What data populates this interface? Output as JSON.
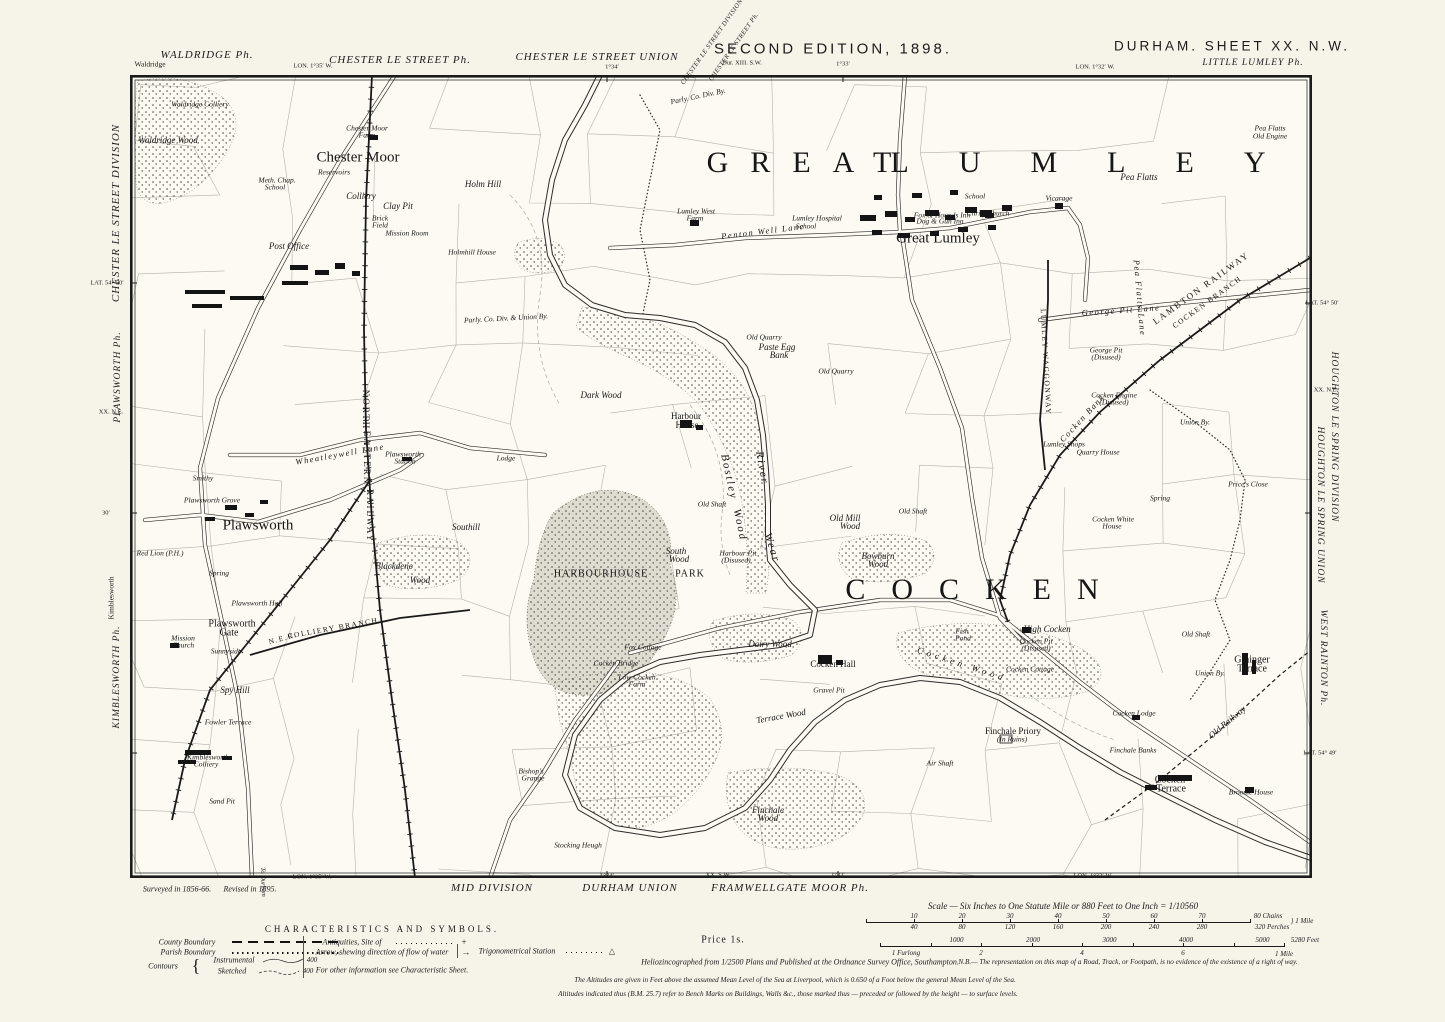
{
  "header": {
    "waldridge_ph": "WALDRIDGE Ph.",
    "waldridge_small": "Waldridge",
    "lon_left": "LON. 1°35′ W.",
    "chester_ph": "CHESTER LE STREET Ph.",
    "chester_union": "CHESTER LE STREET UNION",
    "diag_division": "CHESTER LE STREET DIVISION",
    "diag_ph": "CHESTER LE STREET Ph.",
    "adjoining_sheet": "Dur. XIII. S.W.",
    "tick_134": "1°34′",
    "tick_133": "1°33′",
    "edition": "SECOND EDITION, 1898.",
    "sheet_title": "DURHAM.  SHEET  XX. N.W.",
    "little_lumley": "LITTLE LUMLEY Ph.",
    "lon_right": "LON. 1°32′ W."
  },
  "left_margin": {
    "division": "CHESTER LE STREET DIVISION",
    "lat_top": "LAT. 54° 50′",
    "plawsworth_ph": "PLAWSWORTH Ph.",
    "sheet_ne": "XX. N.E.",
    "tick_30": "30′",
    "kimblesworth_small": "Kimblesworth",
    "kimblesworth_ph": "KIMBLESWORTH Ph."
  },
  "right_margin": {
    "lat_top": "LAT. 54° 50′",
    "sheet_ne": "XX. N.E.",
    "division": "HOUGHTON LE SPRING DIVISION",
    "union": "HOUGHTON LE SPRING UNION",
    "west_rainton_ph": "WEST RAINTON Ph.",
    "lat_bottom": "LAT. 54° 49′"
  },
  "footer": {
    "surveyed": "Surveyed in 1856-66.",
    "revised": "Revised in 1895.",
    "to_durham": "To Durham",
    "lon_left": "LON. 1°35′ W.",
    "mid_division": "MID DIVISION",
    "tick_134": "1°34′",
    "durham_union": "DURHAM UNION",
    "sheet_sw": "XX. S.W.",
    "framwellgate": "FRAMWELLGATE MOOR Ph.",
    "tick_133": "1°33′",
    "lon_right": "LON. 1°32′ W."
  },
  "legend": {
    "title": "CHARACTERISTICS AND SYMBOLS.",
    "county": "County Boundary",
    "parish": "Parish Boundary",
    "contours": "Contours",
    "instrumental": "Instrumental",
    "sketched": "Sketched",
    "contour_value": "400",
    "antiquities": "Antiquities, Site of",
    "antiquities_symbol": "+",
    "arrow": "Arrow, shewing direction of flow of water",
    "arrow_symbol": "→",
    "trig": "Trigonometrical Station",
    "trig_symbol": "△",
    "other_info": "For other information see Characteristic Sheet.",
    "price": "Price 1s."
  },
  "imprint": {
    "helio": "Heliozincographed from 1/2500 Plans and Published at the Ordnance Survey Office, Southampton.",
    "nb": "N.B.— The representation on this map of a Road, Track, or Footpath, is no evidence of the existence of a right of way.",
    "altitudes1": "The Altitudes are given in Feet above the assumed Mean Level of the Sea at Liverpool, which is 0.650 of a Foot below the general Mean Level of the Sea.",
    "altitudes2": "Altitudes indicated thus (B.M. 25.7) refer to Bench Marks on Buildings, Walls &c., those marked thus — preceded or followed by the height — to surface levels."
  },
  "scale": {
    "caption": "Scale — Six Inches to One Statute Mile or 880 Feet to One Inch = 1/10560",
    "chains_ticks": [
      "10",
      "20",
      "30",
      "40",
      "50",
      "60",
      "70"
    ],
    "chains_end": "80 Chains",
    "perches_ticks": [
      "40",
      "80",
      "120",
      "160",
      "200",
      "240",
      "280"
    ],
    "perches_end": "320 Perches",
    "mile_label": "1 Mile",
    "feet_ticks": [
      "1000",
      "2000",
      "3000",
      "4000",
      "5000"
    ],
    "feet_end": "5280 Feet",
    "furlong_label": "1 Furlong",
    "furlong_ticks": [
      "2",
      "4",
      "6"
    ],
    "feet_mile": "1 Mile"
  },
  "map": {
    "labels": [
      {
        "t": "GREAT",
        "x": 810,
        "y": 163,
        "s": "big",
        "ls": 22
      },
      {
        "t": "LUMLEY",
        "x": 1103,
        "y": 163,
        "s": "big",
        "ls": 50
      },
      {
        "t": "COCKEN",
        "x": 985,
        "y": 590,
        "s": "big",
        "ls": 26
      },
      {
        "t": "HARBOURHOUSE",
        "x": 601,
        "y": 574,
        "s": "park"
      },
      {
        "t": "PARK",
        "x": 690,
        "y": 574,
        "s": "park"
      },
      {
        "t": "Chester Moor",
        "x": 358,
        "y": 158,
        "s": "place"
      },
      {
        "t": "Plawsworth",
        "x": 258,
        "y": 526,
        "s": "place"
      },
      {
        "t": "Great Lumley",
        "x": 938,
        "y": 239,
        "s": "place"
      },
      {
        "t": "Plawsworth",
        "x": 232,
        "y": 624,
        "s": "place2"
      },
      {
        "t": "Gate",
        "x": 229,
        "y": 633,
        "s": "place2"
      },
      {
        "t": "NORTH",
        "x": 366,
        "y": 410,
        "s": "rail",
        "r": 90
      },
      {
        "t": "EASTERN",
        "x": 367,
        "y": 458,
        "s": "rail",
        "r": 90
      },
      {
        "t": "RAILWAY",
        "x": 370,
        "y": 516,
        "s": "rail",
        "r": 90
      },
      {
        "t": "LAMBTON RAILWAY",
        "x": 1201,
        "y": 288,
        "s": "rail",
        "r": -36
      },
      {
        "t": "COCKEN BRANCH",
        "x": 1207,
        "y": 302,
        "s": "railsm",
        "r": -36
      },
      {
        "t": "N.E.R.",
        "x": 283,
        "y": 638,
        "s": "railsm",
        "r": -15
      },
      {
        "t": "COLLIERY BRANCH",
        "x": 333,
        "y": 628,
        "s": "railsm",
        "r": -10
      },
      {
        "t": "LUMLEY WAGGONWAY",
        "x": 1046,
        "y": 362,
        "s": "railsm",
        "r": 87
      },
      {
        "t": "Old Railway",
        "x": 1227,
        "y": 722,
        "s": "ital",
        "r": -40
      },
      {
        "t": "Penton Well Lane",
        "x": 763,
        "y": 231,
        "s": "lane",
        "r": -7
      },
      {
        "t": "George Pit Lane",
        "x": 1121,
        "y": 310,
        "s": "lane",
        "r": -4
      },
      {
        "t": "Wheatleywell Lane",
        "x": 340,
        "y": 454,
        "s": "lane",
        "r": -10
      },
      {
        "t": "Cocken Bank",
        "x": 1082,
        "y": 418,
        "s": "lane",
        "r": -47
      },
      {
        "t": "Pea Flatts Lane",
        "x": 1140,
        "y": 298,
        "s": "lane",
        "r": 85
      },
      {
        "t": "Parly. Co. Div. & Union By.",
        "x": 506,
        "y": 318,
        "s": "tiny",
        "r": -3
      },
      {
        "t": "Parly. Co. Div. By.",
        "x": 698,
        "y": 96,
        "s": "tiny",
        "r": -12
      },
      {
        "t": "Waldridge Colliery",
        "x": 200,
        "y": 104,
        "s": "tiny"
      },
      {
        "t": "Waldridge Wood",
        "x": 168,
        "y": 140,
        "s": "ital"
      },
      {
        "t": "Chester Moor",
        "x": 367,
        "y": 128,
        "s": "tiny"
      },
      {
        "t": "Farm",
        "x": 367,
        "y": 135,
        "s": "tiny"
      },
      {
        "t": "Meth. Chap.",
        "x": 277,
        "y": 180,
        "s": "tiny"
      },
      {
        "t": "School",
        "x": 275,
        "y": 187,
        "s": "tiny"
      },
      {
        "t": "Reservoirs",
        "x": 334,
        "y": 172,
        "s": "tiny"
      },
      {
        "t": "Colliery",
        "x": 361,
        "y": 196,
        "s": "ital"
      },
      {
        "t": "Clay Pit",
        "x": 398,
        "y": 206,
        "s": "ital"
      },
      {
        "t": "Brick",
        "x": 380,
        "y": 218,
        "s": "tiny"
      },
      {
        "t": "Field",
        "x": 380,
        "y": 225,
        "s": "tiny"
      },
      {
        "t": "Mission Room",
        "x": 407,
        "y": 233,
        "s": "tiny"
      },
      {
        "t": "Post Office",
        "x": 289,
        "y": 246,
        "s": "ital"
      },
      {
        "t": "Holm Hill",
        "x": 483,
        "y": 184,
        "s": "ital"
      },
      {
        "t": "Holmhill House",
        "x": 472,
        "y": 252,
        "s": "tiny"
      },
      {
        "t": "Smithy",
        "x": 203,
        "y": 478,
        "s": "tiny"
      },
      {
        "t": "Plawsworth Grove",
        "x": 212,
        "y": 500,
        "s": "tiny"
      },
      {
        "t": "Plawsworth",
        "x": 403,
        "y": 454,
        "s": "tiny"
      },
      {
        "t": "Station",
        "x": 405,
        "y": 461,
        "s": "tiny"
      },
      {
        "t": "Red Lion (P.H.)",
        "x": 160,
        "y": 553,
        "s": "tiny"
      },
      {
        "t": "Spring",
        "x": 219,
        "y": 573,
        "s": "tiny"
      },
      {
        "t": "Plawsworth Hall",
        "x": 257,
        "y": 603,
        "s": "tiny"
      },
      {
        "t": "Mission",
        "x": 183,
        "y": 638,
        "s": "tiny"
      },
      {
        "t": "Church",
        "x": 183,
        "y": 645,
        "s": "tiny"
      },
      {
        "t": "Sunnyside",
        "x": 226,
        "y": 651,
        "s": "tiny"
      },
      {
        "t": "Spy Hill",
        "x": 235,
        "y": 690,
        "s": "ital"
      },
      {
        "t": "Fowler Terrace",
        "x": 228,
        "y": 722,
        "s": "tiny"
      },
      {
        "t": "Kimblesworth",
        "x": 208,
        "y": 757,
        "s": "tiny"
      },
      {
        "t": "Colliery",
        "x": 206,
        "y": 764,
        "s": "tiny"
      },
      {
        "t": "Sand Pit",
        "x": 222,
        "y": 801,
        "s": "tiny"
      },
      {
        "t": "Blackdene",
        "x": 394,
        "y": 566,
        "s": "ital"
      },
      {
        "t": "Wood",
        "x": 420,
        "y": 580,
        "s": "ital"
      },
      {
        "t": "Southill",
        "x": 466,
        "y": 527,
        "s": "ital"
      },
      {
        "t": "Lodge",
        "x": 506,
        "y": 458,
        "s": "tiny"
      },
      {
        "t": "Dark Wood",
        "x": 601,
        "y": 395,
        "s": "ital"
      },
      {
        "t": "Harbour",
        "x": 686,
        "y": 416,
        "s": "name"
      },
      {
        "t": "House",
        "x": 687,
        "y": 425,
        "s": "name"
      },
      {
        "t": "Bostley",
        "x": 729,
        "y": 477,
        "s": "water",
        "r": 78
      },
      {
        "t": "Wood",
        "x": 740,
        "y": 525,
        "s": "water",
        "r": 78
      },
      {
        "t": "River",
        "x": 762,
        "y": 468,
        "s": "water",
        "r": 80
      },
      {
        "t": "Wear",
        "x": 772,
        "y": 548,
        "s": "water",
        "r": 72
      },
      {
        "t": "Old Shaft",
        "x": 712,
        "y": 504,
        "s": "tiny"
      },
      {
        "t": "Harbour Pit",
        "x": 738,
        "y": 553,
        "s": "tiny"
      },
      {
        "t": "(Disused)",
        "x": 736,
        "y": 560,
        "s": "tiny"
      },
      {
        "t": "South",
        "x": 676,
        "y": 551,
        "s": "ital"
      },
      {
        "t": "Wood",
        "x": 679,
        "y": 559,
        "s": "ital"
      },
      {
        "t": "Old Mill",
        "x": 845,
        "y": 518,
        "s": "ital"
      },
      {
        "t": "Wood",
        "x": 850,
        "y": 526,
        "s": "ital"
      },
      {
        "t": "Old Shaft",
        "x": 913,
        "y": 511,
        "s": "tiny"
      },
      {
        "t": "Bowburn",
        "x": 878,
        "y": 556,
        "s": "ital"
      },
      {
        "t": "Wood",
        "x": 878,
        "y": 564,
        "s": "ital"
      },
      {
        "t": "Old Quarry",
        "x": 764,
        "y": 337,
        "s": "tiny"
      },
      {
        "t": "Paste Egg",
        "x": 777,
        "y": 347,
        "s": "ital"
      },
      {
        "t": "Bank",
        "x": 779,
        "y": 355,
        "s": "ital"
      },
      {
        "t": "Old Quarry",
        "x": 836,
        "y": 371,
        "s": "tiny"
      },
      {
        "t": "High Cocken",
        "x": 1047,
        "y": 629,
        "s": "ital"
      },
      {
        "t": "Cocken Pit",
        "x": 1036,
        "y": 641,
        "s": "tiny"
      },
      {
        "t": "(Disused)",
        "x": 1036,
        "y": 648,
        "s": "tiny"
      },
      {
        "t": "Fish",
        "x": 962,
        "y": 631,
        "s": "tiny"
      },
      {
        "t": "Pond",
        "x": 963,
        "y": 638,
        "s": "tiny"
      },
      {
        "t": "Dairy Wood",
        "x": 770,
        "y": 644,
        "s": "ital"
      },
      {
        "t": "Cocken Hall",
        "x": 833,
        "y": 664,
        "s": "name"
      },
      {
        "t": "Gravel Pit",
        "x": 829,
        "y": 690,
        "s": "tiny"
      },
      {
        "t": "Terrace Wood",
        "x": 781,
        "y": 716,
        "s": "ital",
        "r": -10
      },
      {
        "t": "Cocken Wood",
        "x": 962,
        "y": 664,
        "s": "ital",
        "r": 18,
        "ls": 4
      },
      {
        "t": "Cocken Cottage",
        "x": 1030,
        "y": 669,
        "s": "tiny"
      },
      {
        "t": "Finchale Priory",
        "x": 1013,
        "y": 731,
        "s": "name"
      },
      {
        "t": "(In Ruins)",
        "x": 1012,
        "y": 739,
        "s": "tiny"
      },
      {
        "t": "Air Shaft",
        "x": 940,
        "y": 763,
        "s": "tiny"
      },
      {
        "t": "Finchale",
        "x": 768,
        "y": 810,
        "s": "ital"
      },
      {
        "t": "Wood",
        "x": 768,
        "y": 818,
        "s": "ital"
      },
      {
        "t": "Low Cocken",
        "x": 637,
        "y": 677,
        "s": "tiny"
      },
      {
        "t": "Farm",
        "x": 637,
        "y": 684,
        "s": "tiny"
      },
      {
        "t": "Cocken Bridge",
        "x": 616,
        "y": 663,
        "s": "tiny"
      },
      {
        "t": "Fox Cottage",
        "x": 643,
        "y": 647,
        "s": "tiny"
      },
      {
        "t": "Bishop's",
        "x": 531,
        "y": 771,
        "s": "tiny"
      },
      {
        "t": "Grange",
        "x": 533,
        "y": 778,
        "s": "tiny"
      },
      {
        "t": "Stocking Heugh",
        "x": 578,
        "y": 845,
        "s": "tiny"
      },
      {
        "t": "Finchale Banks",
        "x": 1133,
        "y": 750,
        "s": "tiny"
      },
      {
        "t": "Cocken Lodge",
        "x": 1134,
        "y": 713,
        "s": "tiny"
      },
      {
        "t": "Grainger",
        "x": 1252,
        "y": 660,
        "s": "place2"
      },
      {
        "t": "Terrace",
        "x": 1252,
        "y": 669,
        "s": "place2"
      },
      {
        "t": "Union By.",
        "x": 1210,
        "y": 673,
        "s": "tiny"
      },
      {
        "t": "Union By.",
        "x": 1195,
        "y": 422,
        "s": "tiny"
      },
      {
        "t": "Cocken",
        "x": 1170,
        "y": 780,
        "s": "place2"
      },
      {
        "t": "Terrace",
        "x": 1171,
        "y": 789,
        "s": "place2"
      },
      {
        "t": "Broome House",
        "x": 1251,
        "y": 792,
        "s": "tiny"
      },
      {
        "t": "Old Shaft",
        "x": 1196,
        "y": 634,
        "s": "tiny"
      },
      {
        "t": "George Pit",
        "x": 1106,
        "y": 350,
        "s": "tiny"
      },
      {
        "t": "(Disused)",
        "x": 1106,
        "y": 357,
        "s": "tiny"
      },
      {
        "t": "Cocken Engine",
        "x": 1114,
        "y": 395,
        "s": "tiny"
      },
      {
        "t": "(Disused)",
        "x": 1114,
        "y": 402,
        "s": "tiny"
      },
      {
        "t": "Lumley Shops",
        "x": 1064,
        "y": 444,
        "s": "tiny"
      },
      {
        "t": "Quarry House",
        "x": 1098,
        "y": 452,
        "s": "tiny"
      },
      {
        "t": "Cocken White",
        "x": 1113,
        "y": 519,
        "s": "tiny"
      },
      {
        "t": "House",
        "x": 1112,
        "y": 526,
        "s": "tiny"
      },
      {
        "t": "Spring",
        "x": 1160,
        "y": 498,
        "s": "tiny"
      },
      {
        "t": "Price's Close",
        "x": 1248,
        "y": 484,
        "s": "tiny"
      },
      {
        "t": "Lumley West",
        "x": 696,
        "y": 211,
        "s": "tiny"
      },
      {
        "t": "Farm",
        "x": 695,
        "y": 218,
        "s": "tiny"
      },
      {
        "t": "Lumley Hospital",
        "x": 817,
        "y": 218,
        "s": "tiny"
      },
      {
        "t": "School",
        "x": 806,
        "y": 226,
        "s": "tiny"
      },
      {
        "t": "School",
        "x": 975,
        "y": 196,
        "s": "tiny"
      },
      {
        "t": "Christ Church",
        "x": 988,
        "y": 213,
        "s": "tiny"
      },
      {
        "t": "Fox & Hounds Inn",
        "x": 942,
        "y": 215,
        "s": "tiny"
      },
      {
        "t": "Dog & Gun Inn",
        "x": 940,
        "y": 221,
        "s": "tiny"
      },
      {
        "t": "Vicarage",
        "x": 1059,
        "y": 198,
        "s": "tiny"
      },
      {
        "t": "Pea Flatts",
        "x": 1139,
        "y": 177,
        "s": "ital"
      },
      {
        "t": "Pea Flatts",
        "x": 1270,
        "y": 128,
        "s": "tiny"
      },
      {
        "t": "Old Engine",
        "x": 1270,
        "y": 136,
        "s": "tiny"
      }
    ]
  }
}
